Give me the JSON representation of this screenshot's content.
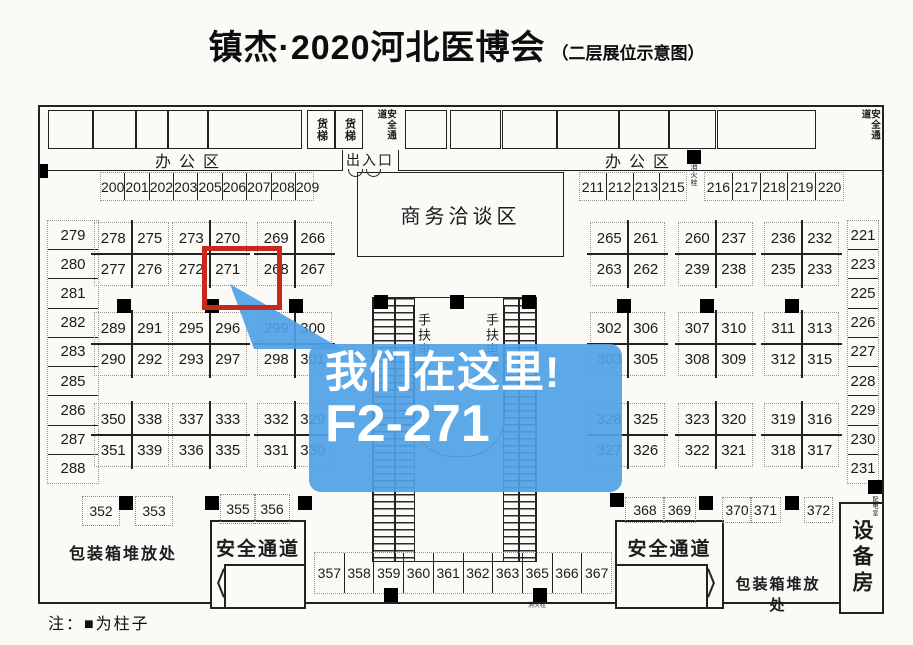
{
  "title": {
    "main": "镇杰·2020河北医博会",
    "sub": "（二层展位示意图）"
  },
  "note": "注：■为柱子",
  "callout": {
    "line1": "我们在这里!",
    "line2": "F2-271"
  },
  "highlight_booth": "271",
  "colors": {
    "callout_blue": "rgba(79,162,230,0.92)",
    "highlight_red": "#c8281e",
    "line": "#222222"
  },
  "labels": {
    "office": "办公区",
    "entrance": "出入口",
    "freight": "货梯",
    "safety": "安全通道",
    "business": "商务洽谈区",
    "escalator": "手扶电梯",
    "packing": "包装箱堆放处",
    "equipment": "设备房",
    "hydrant": "消火栓",
    "power": "配电室"
  },
  "rows": {
    "top_left": [
      "200",
      "201",
      "202",
      "203",
      "205",
      "206",
      "207",
      "208",
      "209"
    ],
    "top_right_a": [
      "211",
      "212",
      "213",
      "215"
    ],
    "top_right_b": [
      "216",
      "217",
      "218",
      "219",
      "220"
    ],
    "left_col": [
      "279",
      "280",
      "281",
      "282",
      "283",
      "285",
      "286",
      "287",
      "288"
    ],
    "right_col": [
      "221",
      "223",
      "225",
      "226",
      "227",
      "228",
      "229",
      "230",
      "231"
    ],
    "bottom_center": [
      "357",
      "358",
      "359",
      "360",
      "361",
      "362",
      "363",
      "365",
      "366",
      "367"
    ]
  },
  "singles": [
    "352",
    "353",
    "355",
    "356",
    "368",
    "369",
    "370",
    "371",
    "372"
  ],
  "islands": [
    {
      "cells": [
        "278",
        "275",
        "277",
        "276"
      ]
    },
    {
      "cells": [
        "273",
        "270",
        "272",
        "271"
      ]
    },
    {
      "cells": [
        "269",
        "266",
        "268",
        "267"
      ]
    },
    {
      "cells": [
        "265",
        "261",
        "263",
        "262"
      ]
    },
    {
      "cells": [
        "260",
        "237",
        "239",
        "238"
      ]
    },
    {
      "cells": [
        "236",
        "232",
        "235",
        "233"
      ]
    },
    {
      "cells": [
        "289",
        "291",
        "290",
        "292"
      ]
    },
    {
      "cells": [
        "295",
        "296",
        "293",
        "297"
      ]
    },
    {
      "cells": [
        "299",
        "300",
        "298",
        "301"
      ]
    },
    {
      "cells": [
        "302",
        "306",
        "303",
        "305"
      ]
    },
    {
      "cells": [
        "307",
        "310",
        "308",
        "309"
      ]
    },
    {
      "cells": [
        "311",
        "313",
        "312",
        "315"
      ]
    },
    {
      "cells": [
        "350",
        "338",
        "351",
        "339"
      ]
    },
    {
      "cells": [
        "337",
        "333",
        "336",
        "335"
      ]
    },
    {
      "cells": [
        "332",
        "329",
        "331",
        "330"
      ]
    },
    {
      "cells": [
        "328",
        "325",
        "327",
        "326"
      ]
    },
    {
      "cells": [
        "323",
        "320",
        "322",
        "321"
      ]
    },
    {
      "cells": [
        "319",
        "316",
        "318",
        "317"
      ]
    }
  ]
}
